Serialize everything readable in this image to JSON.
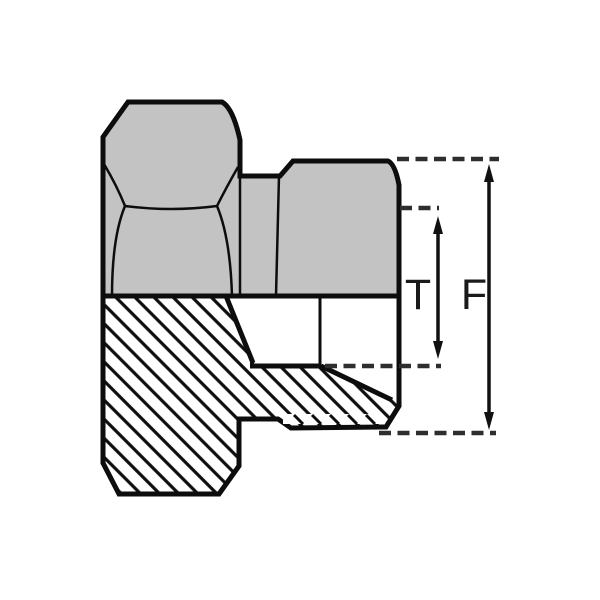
{
  "drawing": {
    "labels": {
      "dim_t": "T",
      "dim_f": "F"
    },
    "dimensions": [
      {
        "label": "T",
        "orientation": "vertical",
        "style": "double-headed-arrow"
      },
      {
        "label": "F",
        "orientation": "vertical",
        "style": "double-headed-arrow"
      }
    ],
    "colors": {
      "body_fill": "#c3c3c3",
      "outline": "#0d0d0d",
      "dash_line": "#2e2e2e",
      "label_color": "#1a1a1a",
      "background": "#ffffff"
    }
  }
}
